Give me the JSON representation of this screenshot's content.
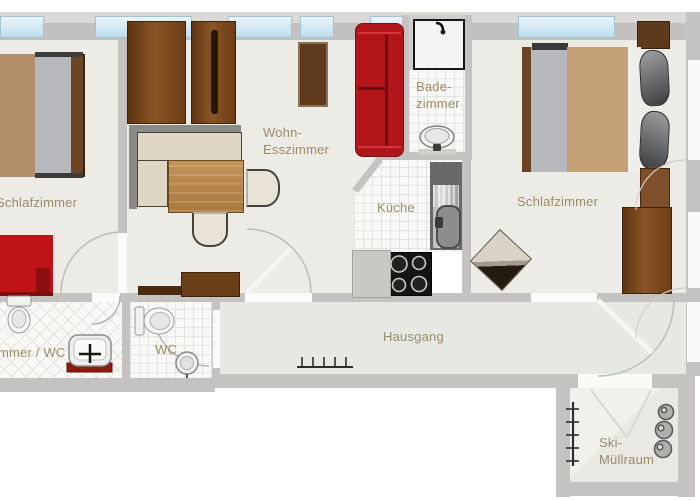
{
  "title": "Apartment floor plan",
  "labels": {
    "bedroom_left": "Schlafzimmer",
    "living_line1": "Wohn-",
    "living_line2": "Esszimmer",
    "bath_line1": "Bade-",
    "bath_line2": "zimmer",
    "kitchen": "Küche",
    "bedroom_right": "Schlafzimmer",
    "room_wc_partial": "mmer / WC",
    "wc": "WC",
    "hall": "Hausgang",
    "ski_line1": "Ski-",
    "ski_line2": "Müllraum"
  },
  "colors": {
    "wall": "#c4c3c1",
    "room_floor": "#edebe6",
    "hall_floor": "#e6e8e3",
    "tile_floor": "#f8f8f6",
    "window_glass": "#cfe9f3",
    "label_text": "#9a8d66",
    "sofa_red": "#b2161b",
    "accent_red": "#c01318",
    "wood_dark": "#6e3d16",
    "wood_table": "#b5854a",
    "mattress_tan": "#c4a077",
    "blanket_gray": "#b5b7ba"
  },
  "fixtures": [
    "double-bed",
    "single-bed",
    "wardrobe",
    "corner-sofa",
    "dining-table",
    "dining-chair",
    "red-sofa",
    "rug",
    "sideboard",
    "shower",
    "bath-sink",
    "kitchen-sink",
    "stove",
    "base-cabinet",
    "toilet",
    "hand-sink",
    "armchair",
    "nightstand",
    "coat-rack",
    "ski-rack",
    "waste-bins",
    "door-swing"
  ]
}
